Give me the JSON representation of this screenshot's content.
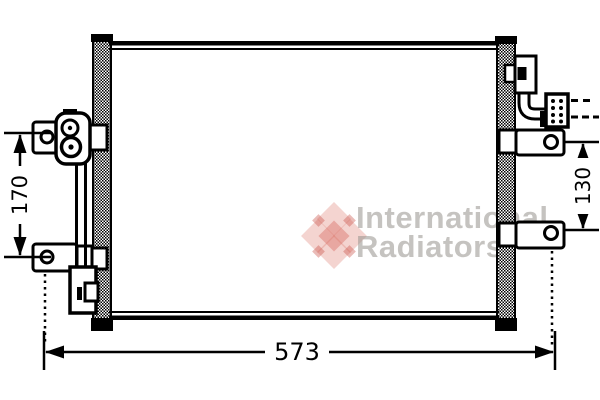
{
  "diagram": {
    "type": "technical-drawing-condenser-front-view",
    "dimension_width": "573",
    "dimension_height_left": "170",
    "dimension_height_right": "130"
  },
  "watermark": {
    "line1": "International",
    "line2": "Radiators",
    "logo": "van-wezel-flower-logo",
    "logo_color": "#de786e",
    "text_color": "#96928d"
  },
  "colors": {
    "line": "#000000",
    "background": "#ffffff"
  }
}
